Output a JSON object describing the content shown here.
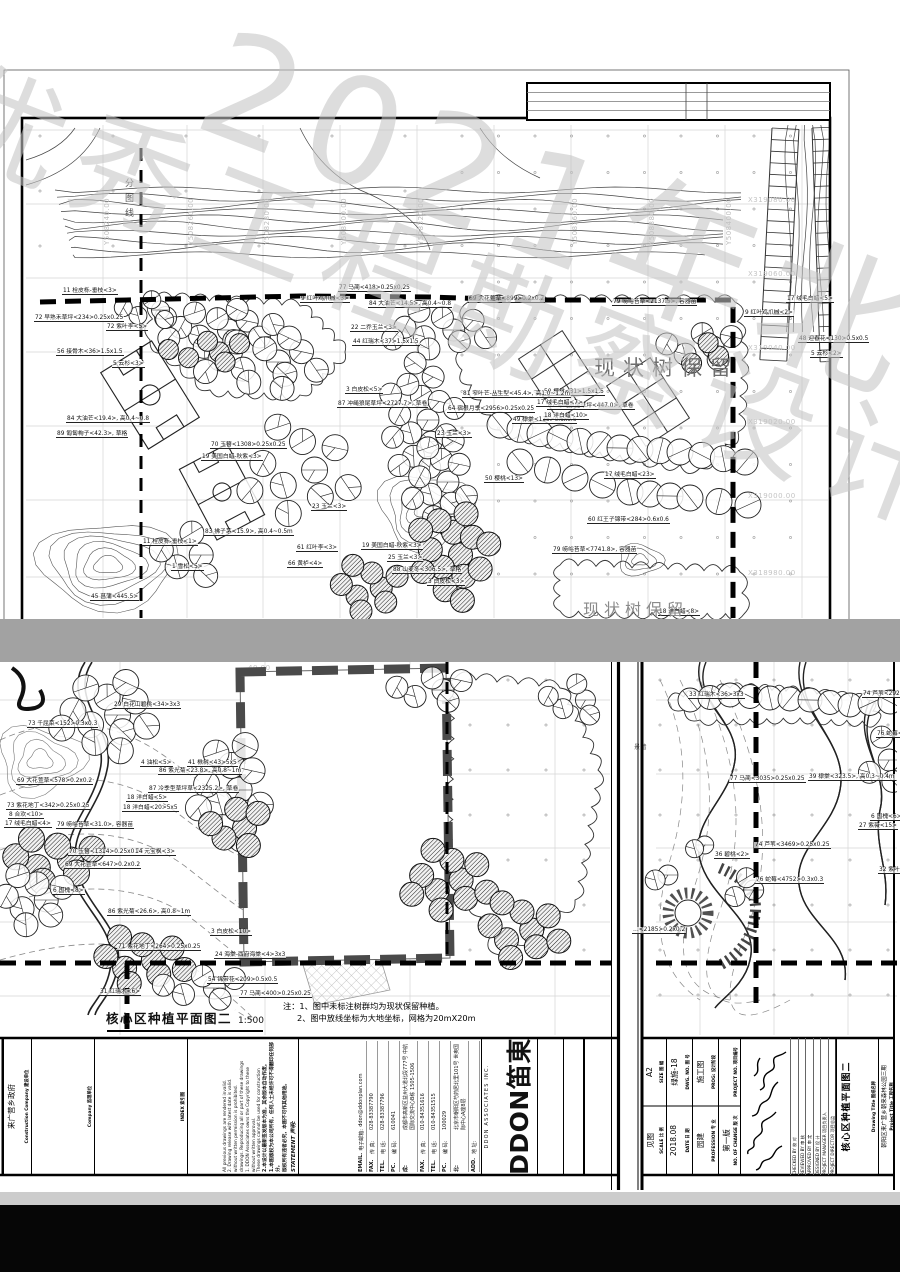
{
  "watermark": {
    "line1": "优秀工程勘察设计奖",
    "line2": "2021年北京市"
  },
  "top": {
    "preserve_label": "现状树保留",
    "preserve_label_2": "现状树保留",
    "division_label": "分图线",
    "grid_y": [
      [
        103,
        "Y508240.00"
      ],
      [
        187,
        "Y508260.00"
      ],
      [
        263,
        "Y508280.00"
      ],
      [
        340,
        "Y508300.00"
      ],
      [
        417,
        "Y508320.00"
      ],
      [
        571,
        "Y508360.00"
      ],
      [
        648,
        "Y508380.00"
      ],
      [
        725,
        "Y508400.00"
      ]
    ],
    "grid_x": [
      [
        204,
        "X319080.00"
      ],
      [
        278,
        "X319060.00"
      ],
      [
        352,
        "X319040.00"
      ],
      [
        426,
        "X319020.00"
      ],
      [
        500,
        "X319000.00"
      ],
      [
        577,
        "X318980.00"
      ]
    ],
    "plant_labels": [
      [
        62,
        288,
        "11 栓皮栎-垂枝<3>"
      ],
      [
        338,
        285,
        "77 马蔺<418>0.25x0.25"
      ],
      [
        300,
        296,
        "9 红叶鸡爪槭<3>"
      ],
      [
        468,
        296,
        "69 大花萱草<899>0.2x0.2"
      ],
      [
        786,
        296,
        "17 绒毛白蜡<5>"
      ],
      [
        744,
        310,
        "9 红叶鸡爪槭<2>"
      ],
      [
        34,
        315,
        "72 早熟禾草坪<234>0.25x0.25"
      ],
      [
        106,
        324,
        "72 紫叶李<5>"
      ],
      [
        798,
        336,
        "48 迎春花<130>0.5x0.5"
      ],
      [
        56,
        349,
        "56 接骨木<36>1.5x1.5"
      ],
      [
        112,
        361,
        "5 云杉<3>"
      ],
      [
        810,
        351,
        "5 云杉<2>"
      ],
      [
        612,
        299,
        "79 崂峪苔草<2137.5>, 容器苗"
      ],
      [
        368,
        301,
        "84 大油芒<14.5>, 高0.4~0.8"
      ],
      [
        350,
        325,
        "22 二乔玉兰<3>"
      ],
      [
        352,
        339,
        "44 红瑞木<37>1.5x1.5"
      ],
      [
        543,
        389,
        "50 樱桃<31>1.5x1.5"
      ],
      [
        547,
        403,
        "87 冲绳狼尾草坪<447.0>, 草卷"
      ],
      [
        512,
        417,
        "49 棣棠<135>0.6x0.6"
      ],
      [
        436,
        431,
        "23 玉兰<3>"
      ],
      [
        66,
        416,
        "84 大油芒<19.4>, 高0.4~0.8"
      ],
      [
        56,
        431,
        "89 匍匐栒子<42.3>, 草格"
      ],
      [
        462,
        391,
        "81 窄叶芒-丛生型<45.4>, 高1.0~1.2m"
      ],
      [
        447,
        406,
        "64 宿根月季<2956>0.25x0.25"
      ],
      [
        536,
        400,
        "17 绒毛白蜡<7>"
      ],
      [
        543,
        413,
        "18 洋白蜡<10>"
      ],
      [
        345,
        387,
        "3 白皮松<5>"
      ],
      [
        337,
        401,
        "87 冲绳狼尾草坪<2727.7>, 草卷"
      ],
      [
        484,
        476,
        "50 樱桃<13>"
      ],
      [
        604,
        472,
        "17 绒毛白蜡<23>"
      ],
      [
        587,
        517,
        "60 红王子锦带<284>0.6x0.6"
      ],
      [
        552,
        547,
        "79 崂峪苔草<7741.8>, 容器苗"
      ],
      [
        311,
        504,
        "23 玉兰<3>"
      ],
      [
        204,
        529,
        "83 拂子茅<15.9>, 高0.4~0.5m"
      ],
      [
        142,
        539,
        "11 栓皮栎-垂枝<1>"
      ],
      [
        171,
        564,
        "1 雪松<5>"
      ],
      [
        296,
        545,
        "61 红叶李<3>"
      ],
      [
        287,
        561,
        "66 黄栌<4>"
      ],
      [
        361,
        543,
        "19 美国白蜡-秋紫<3>"
      ],
      [
        387,
        555,
        "25 玉兰<3>"
      ],
      [
        392,
        567,
        "88 山麦冬<306.5>, 草格"
      ],
      [
        427,
        579,
        "3 白皮松<3>"
      ],
      [
        90,
        594,
        "45 菖蒲<445.5>"
      ],
      [
        210,
        442,
        "70 玉簪<1308>0.25x0.25"
      ],
      [
        201,
        454,
        "19 美国白蜡-秋紫<3>"
      ],
      [
        658,
        609,
        "18 洋白蜡<8>"
      ]
    ]
  },
  "bl": {
    "grid_label": "40.00",
    "plant_labels": [
      [
        113,
        702,
        "29 白花山碧桃<34>3x3"
      ],
      [
        27,
        721,
        "73 千屈菜<152>0.3x0.3"
      ],
      [
        16,
        778,
        "69 大花萱草<578>0.2x0.2"
      ],
      [
        140,
        760,
        "4 油松<5>"
      ],
      [
        187,
        760,
        "41 楸树<43>5x5"
      ],
      [
        158,
        768,
        "86 紫光菊<23.8>, 高0.8~1m"
      ],
      [
        148,
        786,
        "87 冷季型草坪草<2325.2>, 草卷"
      ],
      [
        126,
        795,
        "18 洋白蜡<5>"
      ],
      [
        122,
        805,
        "18 洋白蜡<20>5x5"
      ],
      [
        6,
        803,
        "73 紫花地丁<342>0.25x0.25"
      ],
      [
        8,
        812,
        "8 合欢<10>"
      ],
      [
        4,
        821,
        "17 绒毛白蜡<4>"
      ],
      [
        56,
        822,
        "79 崂峪苔草<31.0>, 容器苗"
      ],
      [
        68,
        849,
        "70 玉簪<1314>0.25x0.25"
      ],
      [
        134,
        849,
        "14 元宝枫<3>"
      ],
      [
        64,
        862,
        "69 大花萱草<647>0.2x0.2"
      ],
      [
        107,
        909,
        "86 紫光菊<26.6>, 高0.8~1m"
      ],
      [
        52,
        888,
        "6 国槐<8>"
      ],
      [
        117,
        944,
        "71 紫花地丁<264>0.25x0.25"
      ],
      [
        210,
        929,
        "3 白皮松<10>"
      ],
      [
        214,
        952,
        "24 海棠-西府海棠<4>3x3"
      ],
      [
        207,
        977,
        "54 锦带花<209>0.5x0.5"
      ],
      [
        239,
        991,
        "77 马蔺<400>0.25x0.25"
      ],
      [
        99,
        989,
        "31 红瑞木<6>"
      ]
    ],
    "note_prefix": "注：",
    "note1": "1、图中未标注树群均为现状保留种植。",
    "note2": "2、图中放线坐标为大地坐标，网格为20mX20m",
    "title": "核心区种植平面图二",
    "scale": "1:500"
  },
  "br": {
    "wall_label": "景墙",
    "plant_labels": [
      [
        688,
        692,
        "33 红瑞木<36>3x3"
      ],
      [
        862,
        691,
        "74 芦苇<2927>0.25x0.25"
      ],
      [
        876,
        731,
        "76 蛇莓<2679>0.3x0.3"
      ],
      [
        729,
        776,
        "77 马蔺<3035>0.25x0.25"
      ],
      [
        808,
        774,
        "39 棣棠<323.5>, 高0.3~0.4m"
      ],
      [
        870,
        814,
        "6 国槐<6>"
      ],
      [
        858,
        823,
        "27 紫薇<15>"
      ],
      [
        754,
        842,
        "74 芦苇<3469>0.25x0.25"
      ],
      [
        714,
        852,
        "36 碧桃<2>"
      ],
      [
        755,
        877,
        "76 蛇莓<4752>0.3x0.3"
      ],
      [
        878,
        867,
        "32 紫叶李<5>"
      ],
      [
        632,
        927,
        "…<2185>0.2x0.2"
      ]
    ]
  },
  "tbl": {
    "construction_en": "Construction Company",
    "construction_zh": "建设单位",
    "construction_value": "来广营乡政府",
    "supervision_en": "Company",
    "supervision_zh": "监理单位",
    "index_en": "INDEX",
    "index_zh": "索引图",
    "statement_en": "STATEMENT",
    "statement_zh": "声明:",
    "statement_cn": [
      "版权所有违者必究，本图不可作其他用途。",
      "1.本图版权为本公司所有，任何人士未经许可不得翻印任何部分。",
      "2.本设计以最新签发版本为准，其余版本自动作废。"
    ],
    "statement_en_lines": [
      "These drawings cannot be used for construction",
      "without written approval.",
      "1. DDON Associates owns the Copyright to these",
      "drawings. Reproducing all or part of these drawings",
      "without written permission is prohibited.",
      "2. Drawing release with latest date is valid.",
      "All previous drawings are rendered invalid."
    ],
    "contact_rows": [
      {
        "k": "ADD.",
        "kz": "地 址:",
        "v": ""
      },
      {
        "k": "北:",
        "kz": "",
        "v": "北京市朝阳区芍药居北里101号 世奥国际中心A座8层"
      },
      {
        "k": "PC.",
        "kz": "编 码:",
        "v": "100029"
      },
      {
        "k": "TEL.",
        "kz": "电 话:",
        "v": "010-84351515"
      },
      {
        "k": "FAX.",
        "kz": "传 真:",
        "v": "010-84351616"
      },
      {
        "k": "成:",
        "kz": "",
        "v": "成都市高新区益州大道北段777号 中航国际交流中心B栋 1505-1506"
      },
      {
        "k": "PC.",
        "kz": "编 码:",
        "v": "610041"
      },
      {
        "k": "TEL.",
        "kz": "电 话:",
        "v": "028-83387796"
      },
      {
        "k": "FAX.",
        "kz": "传 真:",
        "v": "028-83387790"
      },
      {
        "k": "EMAIL.",
        "kz": "电子邮箱:",
        "v": "ddon@ddonplan.com"
      }
    ],
    "logo_main": "DDON笛東",
    "logo_sub": "DDON ASSOCIATES INC."
  },
  "tbr": {
    "project_title_en": "Project Title",
    "project_title_zh": "工程名称",
    "project_title_value": "朝阳区来广营乡朝来森林公园三期",
    "drawing_title_en": "Drawing Title",
    "drawing_title_zh": "图纸名称",
    "drawing_title_value": "核心区种植平面图二",
    "roles": [
      {
        "en": "PROJECT DIRECTOR",
        "zh": "项目总监"
      },
      {
        "en": "PROJECT MANAGER",
        "zh": "项目负责人"
      },
      {
        "en": "DESIGNED BY",
        "zh": "设 计"
      },
      {
        "en": "APPROVED BY",
        "zh": "审 定"
      },
      {
        "en": "REVIEWED BY",
        "zh": "审 核"
      },
      {
        "en": "CHECKED BY",
        "zh": "校 对"
      }
    ],
    "fields": [
      {
        "en": "SIZE",
        "zh": "图 幅",
        "value": "A2"
      },
      {
        "en": "SCALE",
        "zh": "比 例",
        "value": "见图"
      },
      {
        "en": "DWG. NO.",
        "zh": "图 号",
        "value": "绿施-18"
      },
      {
        "en": "DATE",
        "zh": "日 期",
        "value": "2018.08"
      },
      {
        "en": "PROG:",
        "zh": "设计阶段",
        "value": "施工图"
      },
      {
        "en": "PROFESSION",
        "zh": "专 业",
        "value": "园建"
      },
      {
        "en": "PROJECT NO.",
        "zh": "项目编号",
        "value": ""
      },
      {
        "en": "NO. OF CHANGE",
        "zh": "版 次",
        "value": "第一版"
      }
    ]
  }
}
